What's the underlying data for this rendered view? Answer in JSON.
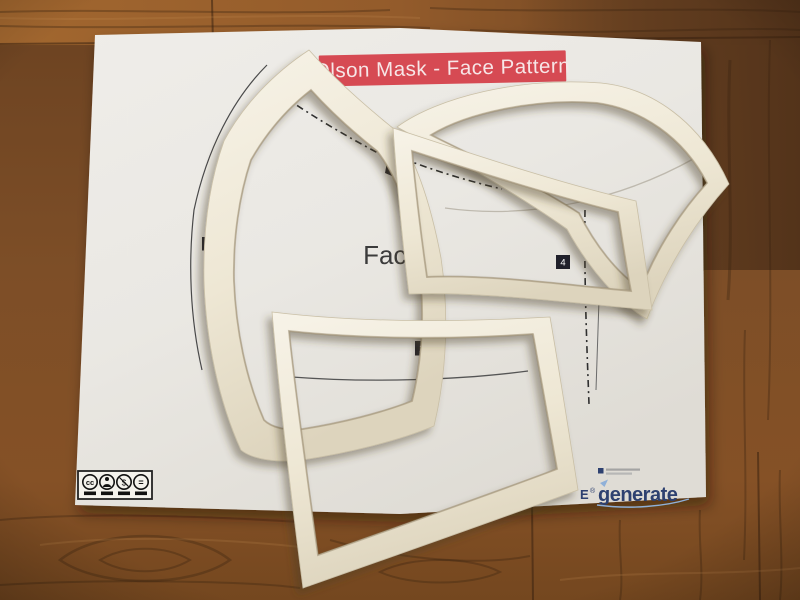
{
  "scene": {
    "type": "photograph",
    "description": "Olson Mask face pattern paper sheet on a wooden table with white 3D-printed tracing frames laid over the printed pattern pieces"
  },
  "sheet": {
    "banner": {
      "title": "Olson Mask - Face Pattern"
    },
    "center_label": "Face",
    "piece_badges": {
      "left": "3",
      "right": "4",
      "bottom": "2"
    },
    "license": {
      "icons": [
        {
          "name": "cc-icon",
          "glyph": "cc"
        },
        {
          "name": "attribution-icon",
          "glyph": "person"
        },
        {
          "name": "non-commercial-icon",
          "glyph": "$"
        },
        {
          "name": "no-derivatives-icon",
          "glyph": "="
        }
      ]
    },
    "footer": {
      "partial_logo_text": "E",
      "registered_mark": "®",
      "brand": "generate"
    }
  },
  "colors": {
    "banner_red": "#d64a53",
    "banner_text": "#f7e6e7",
    "paper": "#eae8e3",
    "frame_white": "#f2edde",
    "wood_mid": "#7b4c26",
    "wood_light": "#9a5f2e",
    "wood_dark": "#5d3a1e",
    "brand_navy": "#2e4170",
    "brand_light_blue": "#8fb0d8",
    "badge_black": "#20202a",
    "print_line": "#3a3a3a"
  }
}
